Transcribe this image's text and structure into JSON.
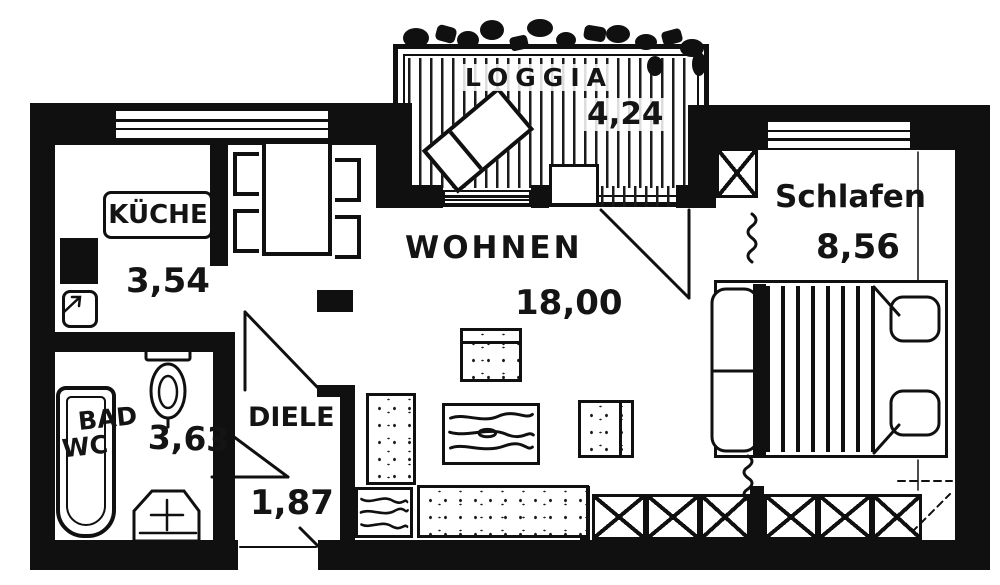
{
  "plan_type": "floor-plan",
  "colors": {
    "ink": "#101010",
    "paper": "#ffffff"
  },
  "rooms": {
    "loggia": {
      "label": "LOGGIA",
      "area": "4,24"
    },
    "kueche": {
      "label": "KÜCHE",
      "area": "3,54"
    },
    "wohnen": {
      "label": "WOHNEN",
      "area": "18,00"
    },
    "schlafen": {
      "label": "Schlafen",
      "area": "8,56"
    },
    "bad": {
      "label1": "BAD",
      "label2": "WC",
      "area": "3,63"
    },
    "diele": {
      "label": "DIELE",
      "area": "1,87"
    }
  }
}
